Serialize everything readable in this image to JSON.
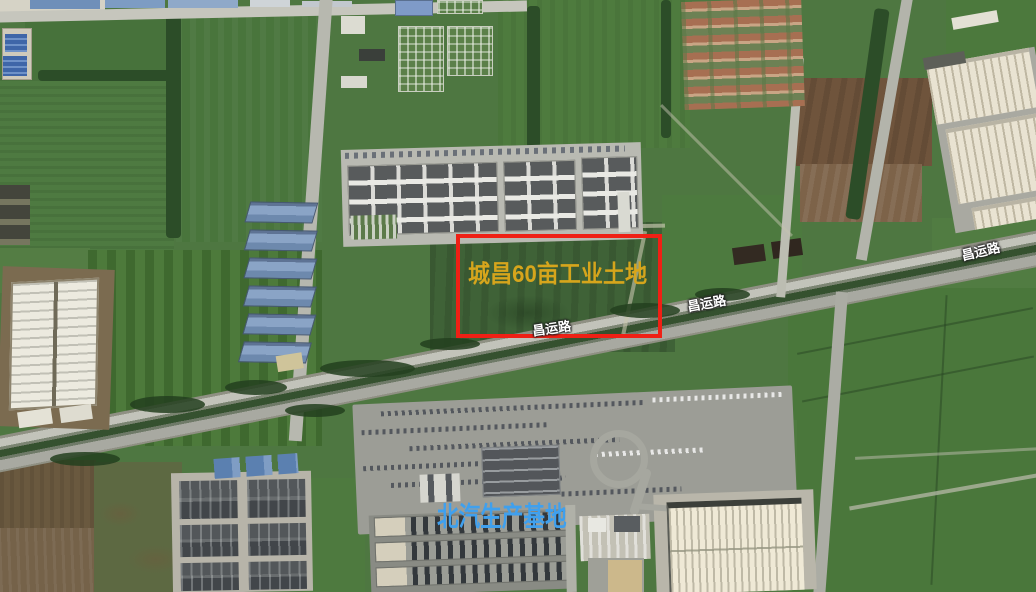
{
  "map": {
    "type": "satellite",
    "parcel_annotation": {
      "label": "城昌60亩工业土地",
      "label_color": "#d6a51c",
      "box_color": "#ef2015"
    },
    "road_labels": [
      {
        "text": "昌运路"
      },
      {
        "text": "昌运路"
      },
      {
        "text": "昌运路"
      }
    ],
    "poi_label": {
      "text": "北汽生产基地",
      "color": "#3fa0ee"
    }
  }
}
